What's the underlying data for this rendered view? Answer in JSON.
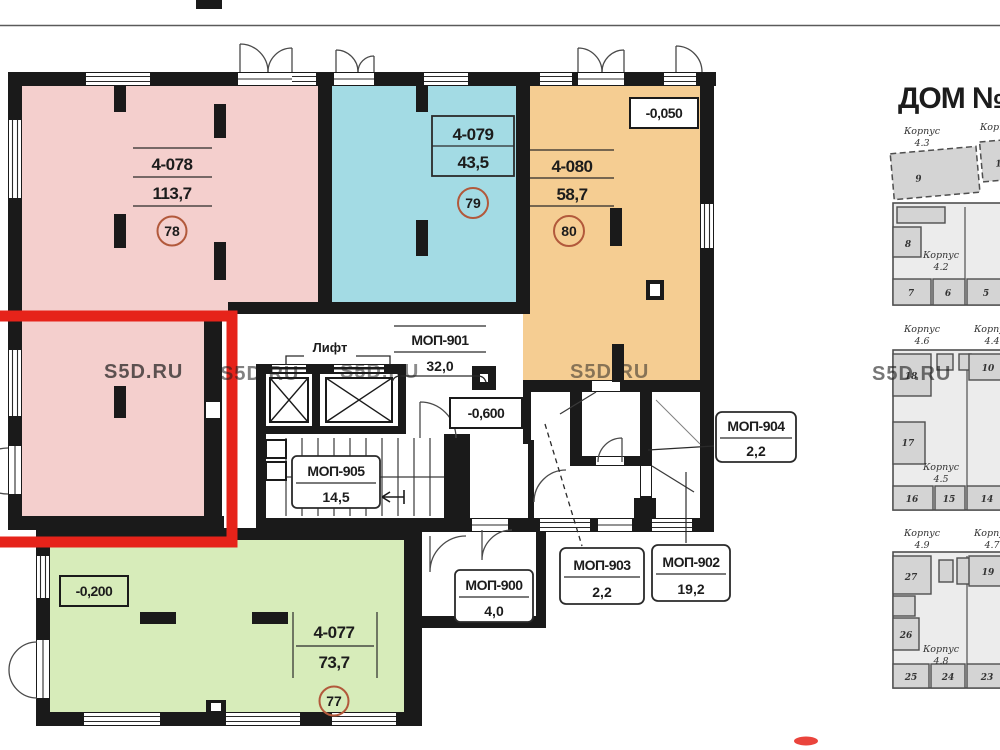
{
  "watermark": "S5D.RU",
  "lift_label": "Лифт",
  "colors": {
    "pink": "#f4cfcd",
    "cyan": "#a3dbe4",
    "orange": "#f5cd92",
    "green": "#d7ecba",
    "red": "#e6231a",
    "circle": "#b2593b"
  },
  "apartments": [
    {
      "id": "4-078",
      "area": "113,7",
      "number": "78"
    },
    {
      "id": "4-079",
      "area": "43,5",
      "number": "79"
    },
    {
      "id": "4-080",
      "area": "58,7",
      "number": "80"
    },
    {
      "id": "4-077",
      "area": "73,7",
      "number": "77"
    }
  ],
  "common_areas": [
    {
      "id": "МОП-901",
      "area": "32,0"
    },
    {
      "id": "МОП-905",
      "area": "14,5"
    },
    {
      "id": "МОП-900",
      "area": "4,0"
    },
    {
      "id": "МОП-903",
      "area": "2,2"
    },
    {
      "id": "МОП-902",
      "area": "19,2"
    },
    {
      "id": "МОП-904",
      "area": "2,2"
    }
  ],
  "elevations": [
    "-0,050",
    "-0,600",
    "-0,200"
  ],
  "site_plan": {
    "title": "ДОМ №4",
    "blocks": [
      {
        "name": "Корпус",
        "num": "4.3"
      },
      {
        "name": "Корпус",
        "num": ""
      },
      {
        "name": "Корпус",
        "num": "4.2"
      },
      {
        "name": "Корпус",
        "num": "4.6"
      },
      {
        "name": "Корпус",
        "num": "4.4"
      },
      {
        "name": "Корпус",
        "num": "4.5"
      },
      {
        "name": "Корпус",
        "num": "4.9"
      },
      {
        "name": "Корпус",
        "num": "4.7"
      },
      {
        "name": "Корпус",
        "num": "4.8"
      }
    ],
    "units": [
      "9",
      "1",
      "8",
      "7",
      "6",
      "5",
      "18",
      "10",
      "17",
      "16",
      "15",
      "14",
      "27",
      "19",
      "26",
      "25",
      "24",
      "23"
    ]
  }
}
